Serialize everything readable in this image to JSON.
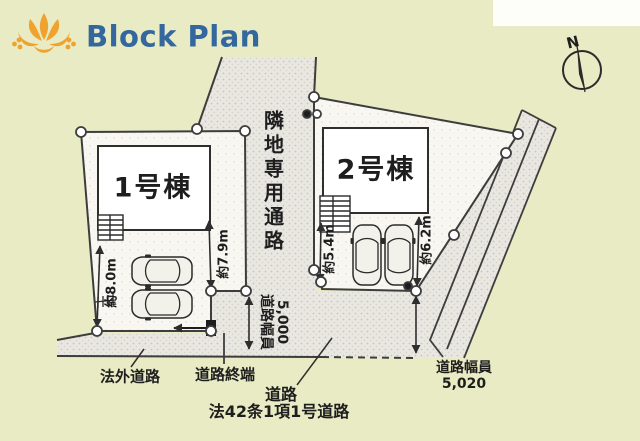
{
  "header": {
    "title": "Block Plan"
  },
  "compass": {
    "north_label": "N"
  },
  "site": {
    "buildings": [
      {
        "label": "1号棟"
      },
      {
        "label": "2号棟"
      }
    ],
    "passage_label": "隣地専用通路",
    "measurements": {
      "lot1_left": "約8.0m",
      "lot1_right": "約7.9m",
      "lot2_left": "約5.4m",
      "lot2_right": "約6.2m"
    },
    "front_road_width": {
      "label": "道路幅員",
      "value": "5,000"
    },
    "east_road_width": {
      "label": "道路幅員",
      "value": "5,020"
    },
    "road_labels": {
      "off_plan": "法外道路",
      "terminus": "道路終端",
      "road": "道路",
      "statute": "法42条1項1号道路"
    }
  },
  "icons": {
    "logo": "lotus-flower-icon",
    "compass": "compass-north-icon"
  },
  "colors": {
    "background": "#e8ebc3",
    "title_blue": "#33679e",
    "logo_orange": "#f0a22e",
    "road_fill": "#e9e7e1",
    "lot_fill": "#f8f7f1",
    "line": "#3d3d3d"
  }
}
